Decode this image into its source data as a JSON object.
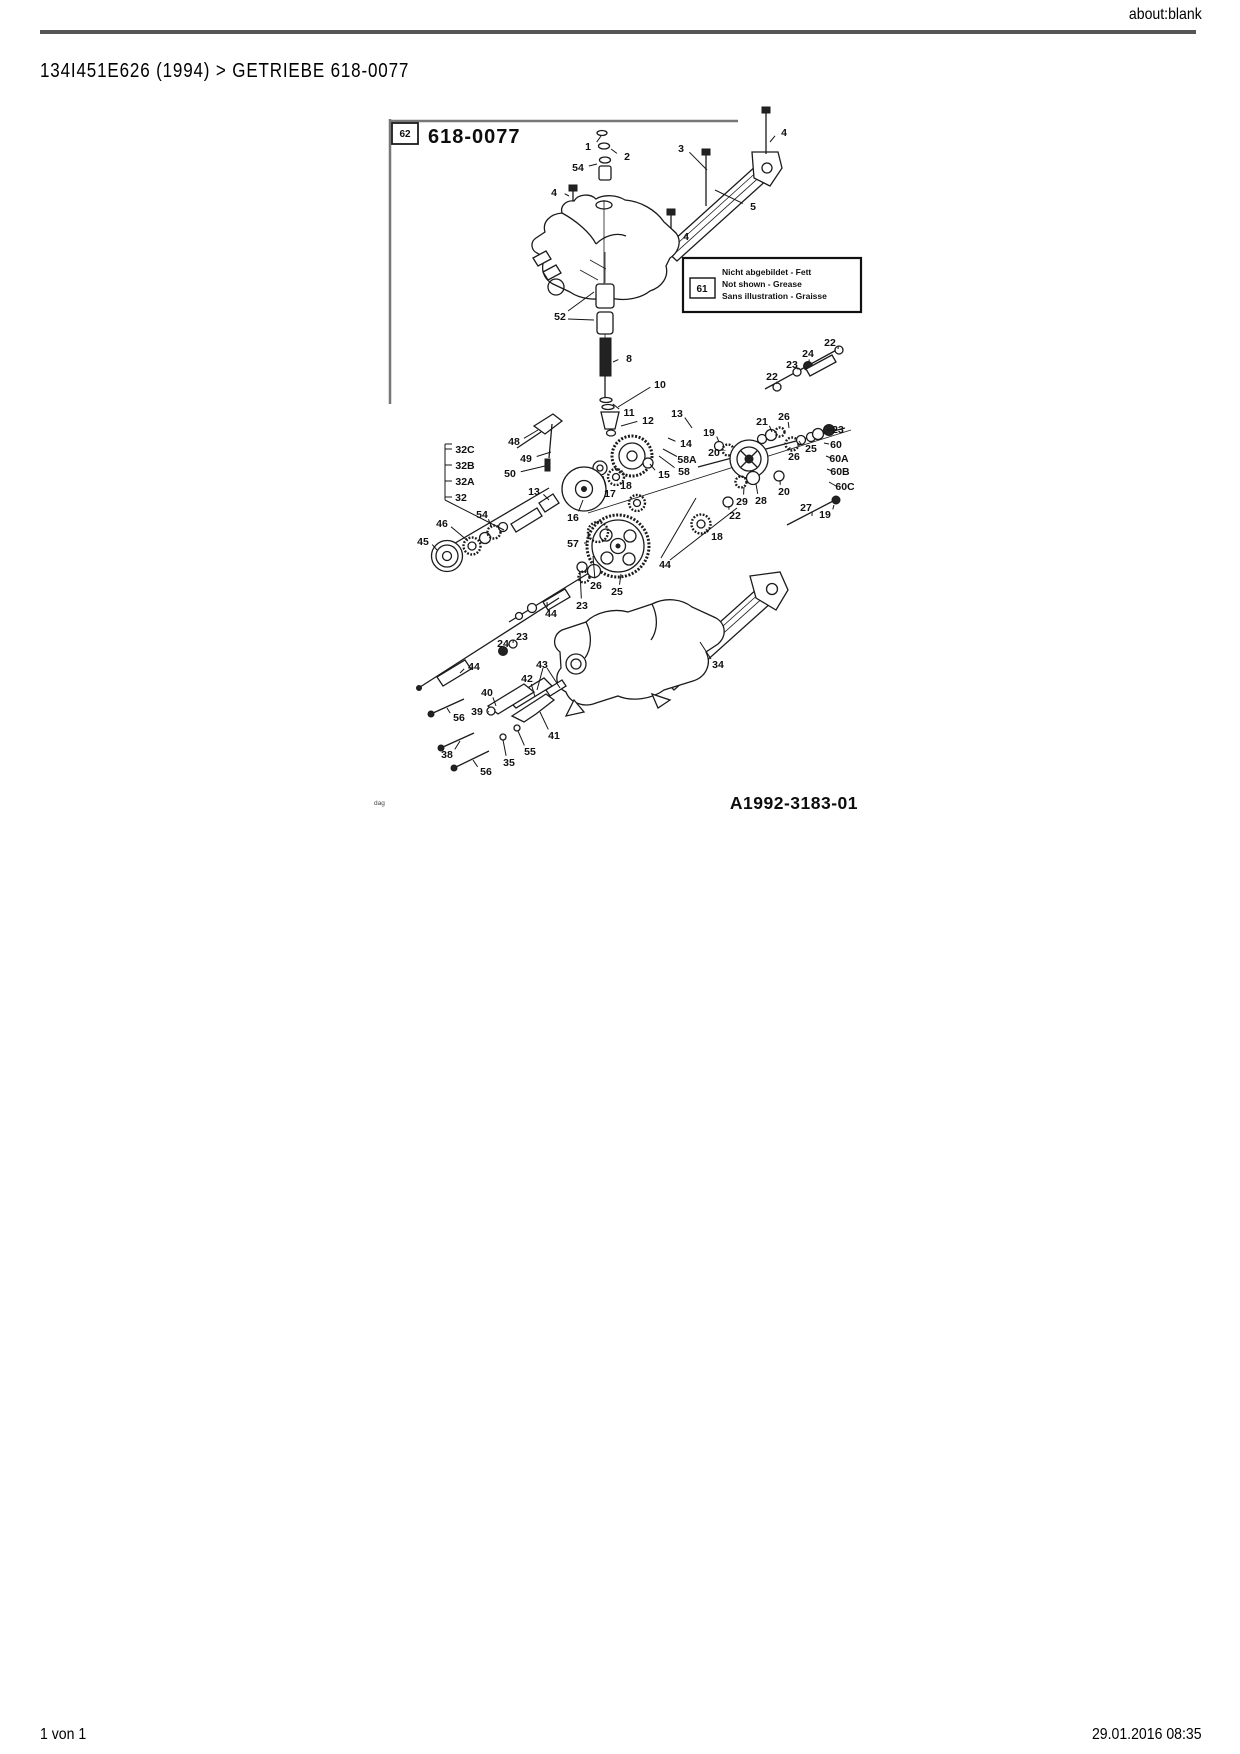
{
  "page": {
    "header_right": "about:blank",
    "breadcrumb": "134I451E626 (1994)  >  GETRIEBE  618-0077",
    "footer_left": "1 von 1",
    "footer_right": "29.01.2016 08:35"
  },
  "diagram": {
    "ref_box_label": "62",
    "title": "618-0077",
    "drawing_number": "A1992-3183-01",
    "watermark": "dag",
    "legend": {
      "box_label": "61",
      "lines": [
        "Nicht abgebildet - Fett",
        "Not shown - Grease",
        "Sans illustration - Graisse"
      ]
    },
    "part_labels": [
      {
        "t": "1",
        "x": 588,
        "y": 146,
        "lx": 601,
        "ly": 136
      },
      {
        "t": "2",
        "x": 627,
        "y": 156,
        "lx": 611,
        "ly": 149
      },
      {
        "t": "54",
        "x": 578,
        "y": 167,
        "lx": 597,
        "ly": 164
      },
      {
        "t": "3",
        "x": 681,
        "y": 148,
        "lx": 707,
        "ly": 170
      },
      {
        "t": "4",
        "x": 784,
        "y": 132,
        "lx": 770,
        "ly": 142
      },
      {
        "t": "4",
        "x": 554,
        "y": 192,
        "lx": 569,
        "ly": 196
      },
      {
        "t": "5",
        "x": 753,
        "y": 206,
        "lx": 715,
        "ly": 190
      },
      {
        "t": "4",
        "x": 686,
        "y": 236,
        "lx": 673,
        "ly": 230
      },
      {
        "t": "52",
        "x": 560,
        "y": 316
      },
      {
        "t": "8",
        "x": 629,
        "y": 358,
        "lx": 613,
        "ly": 362
      },
      {
        "t": "10",
        "x": 660,
        "y": 384,
        "lx": 618,
        "ly": 407
      },
      {
        "t": "11",
        "x": 629,
        "y": 412,
        "lx": 613,
        "ly": 404
      },
      {
        "t": "12",
        "x": 648,
        "y": 420,
        "lx": 621,
        "ly": 426
      },
      {
        "t": "13",
        "x": 677,
        "y": 413,
        "lx": 692,
        "ly": 428
      },
      {
        "t": "14",
        "x": 686,
        "y": 443,
        "lx": 668,
        "ly": 438
      },
      {
        "t": "58A",
        "x": 687,
        "y": 459,
        "lx": 663,
        "ly": 449
      },
      {
        "t": "58",
        "x": 684,
        "y": 471,
        "lx": 659,
        "ly": 456
      },
      {
        "t": "15",
        "x": 664,
        "y": 474,
        "lx": 650,
        "ly": 464
      },
      {
        "t": "19",
        "x": 709,
        "y": 432,
        "lx": 719,
        "ly": 442
      },
      {
        "t": "20",
        "x": 714,
        "y": 452,
        "lx": 725,
        "ly": 450
      },
      {
        "t": "18",
        "x": 626,
        "y": 485,
        "lx": 618,
        "ly": 479
      },
      {
        "t": "17",
        "x": 610,
        "y": 493,
        "lx": 603,
        "ly": 476
      },
      {
        "t": "16",
        "x": 573,
        "y": 517,
        "lx": 583,
        "ly": 500
      },
      {
        "t": "57",
        "x": 573,
        "y": 543,
        "lx": 587,
        "ly": 543
      },
      {
        "t": "48",
        "x": 514,
        "y": 441,
        "lx": 538,
        "ly": 430
      },
      {
        "t": "49",
        "x": 526,
        "y": 458,
        "lx": 551,
        "ly": 452
      },
      {
        "t": "50",
        "x": 510,
        "y": 473,
        "lx": 545,
        "ly": 466
      },
      {
        "t": "13",
        "x": 534,
        "y": 491,
        "lx": 549,
        "ly": 500
      },
      {
        "t": "32C",
        "x": 465,
        "y": 449
      },
      {
        "t": "32B",
        "x": 465,
        "y": 465
      },
      {
        "t": "32A",
        "x": 465,
        "y": 481
      },
      {
        "t": "32",
        "x": 461,
        "y": 497
      },
      {
        "t": "46",
        "x": 442,
        "y": 523,
        "lx": 468,
        "ly": 541
      },
      {
        "t": "54",
        "x": 482,
        "y": 514,
        "lx": 492,
        "ly": 528
      },
      {
        "t": "45",
        "x": 423,
        "y": 541,
        "lx": 437,
        "ly": 550
      },
      {
        "t": "22",
        "x": 830,
        "y": 342,
        "lx": 838,
        "ly": 349
      },
      {
        "t": "24",
        "x": 808,
        "y": 353,
        "lx": 809,
        "ly": 362
      },
      {
        "t": "23",
        "x": 792,
        "y": 364,
        "lx": 797,
        "ly": 369
      },
      {
        "t": "22",
        "x": 772,
        "y": 376,
        "lx": 776,
        "ly": 384
      },
      {
        "t": "26",
        "x": 784,
        "y": 416,
        "lx": 789,
        "ly": 428
      },
      {
        "t": "21",
        "x": 762,
        "y": 421,
        "lx": 772,
        "ly": 432
      },
      {
        "t": "23",
        "x": 838,
        "y": 429,
        "lx": 833,
        "ly": 430
      },
      {
        "t": "60",
        "x": 836,
        "y": 444
      },
      {
        "t": "25",
        "x": 811,
        "y": 448,
        "lx": 799,
        "ly": 441
      },
      {
        "t": "26",
        "x": 794,
        "y": 456,
        "lx": 790,
        "ly": 447
      },
      {
        "t": "60A",
        "x": 839,
        "y": 458
      },
      {
        "t": "60B",
        "x": 840,
        "y": 471
      },
      {
        "t": "60C",
        "x": 845,
        "y": 486
      },
      {
        "t": "20",
        "x": 784,
        "y": 491,
        "lx": 780,
        "ly": 480
      },
      {
        "t": "29",
        "x": 742,
        "y": 501,
        "lx": 744,
        "ly": 487
      },
      {
        "t": "28",
        "x": 761,
        "y": 500,
        "lx": 756,
        "ly": 484
      },
      {
        "t": "27",
        "x": 806,
        "y": 507,
        "lx": 812,
        "ly": 516
      },
      {
        "t": "19",
        "x": 825,
        "y": 514,
        "lx": 834,
        "ly": 505
      },
      {
        "t": "22",
        "x": 735,
        "y": 515,
        "lx": 729,
        "ly": 506
      },
      {
        "t": "18",
        "x": 717,
        "y": 536,
        "lx": 706,
        "ly": 529
      },
      {
        "t": "44",
        "x": 665,
        "y": 564
      },
      {
        "t": "26",
        "x": 596,
        "y": 585,
        "lx": 593,
        "ly": 556
      },
      {
        "t": "25",
        "x": 617,
        "y": 591,
        "lx": 621,
        "ly": 574
      },
      {
        "t": "23",
        "x": 582,
        "y": 605,
        "lx": 580,
        "ly": 572
      },
      {
        "t": "44",
        "x": 551,
        "y": 613,
        "lx": 547,
        "ly": 602
      },
      {
        "t": "23",
        "x": 522,
        "y": 636,
        "lx": 513,
        "ly": 643
      },
      {
        "t": "24",
        "x": 503,
        "y": 643,
        "lx": 503,
        "ly": 650
      },
      {
        "t": "44",
        "x": 474,
        "y": 666,
        "lx": 460,
        "ly": 673
      },
      {
        "t": "34",
        "x": 718,
        "y": 664,
        "lx": 700,
        "ly": 642
      },
      {
        "t": "43",
        "x": 542,
        "y": 664
      },
      {
        "t": "42",
        "x": 527,
        "y": 678,
        "lx": 535,
        "ly": 697
      },
      {
        "t": "40",
        "x": 487,
        "y": 692,
        "lx": 496,
        "ly": 706
      },
      {
        "t": "39",
        "x": 477,
        "y": 711,
        "lx": 489,
        "ly": 712
      },
      {
        "t": "56",
        "x": 459,
        "y": 717,
        "lx": 447,
        "ly": 708
      },
      {
        "t": "38",
        "x": 447,
        "y": 754,
        "lx": 460,
        "ly": 741
      },
      {
        "t": "35",
        "x": 509,
        "y": 762,
        "lx": 503,
        "ly": 740
      },
      {
        "t": "55",
        "x": 530,
        "y": 751,
        "lx": 518,
        "ly": 731
      },
      {
        "t": "41",
        "x": 554,
        "y": 735,
        "lx": 540,
        "ly": 712
      },
      {
        "t": "56",
        "x": 486,
        "y": 771,
        "lx": 473,
        "ly": 760
      }
    ],
    "leaders": [
      [
        568,
        311,
        594,
        292
      ],
      [
        568,
        319,
        594,
        320
      ],
      [
        661,
        558,
        696,
        498
      ],
      [
        670,
        560,
        737,
        508
      ],
      [
        543,
        668,
        537,
        690
      ],
      [
        547,
        668,
        560,
        688
      ],
      [
        445,
        444,
        445,
        500
      ],
      [
        445,
        444,
        452,
        444
      ],
      [
        445,
        449,
        452,
        449
      ],
      [
        445,
        465,
        452,
        465
      ],
      [
        445,
        481,
        452,
        481
      ],
      [
        445,
        497,
        452,
        497
      ],
      [
        445,
        500,
        504,
        530
      ],
      [
        829,
        444,
        824,
        443
      ],
      [
        831,
        458,
        826,
        456
      ],
      [
        832,
        471,
        827,
        469
      ],
      [
        836,
        486,
        829,
        482
      ]
    ]
  }
}
